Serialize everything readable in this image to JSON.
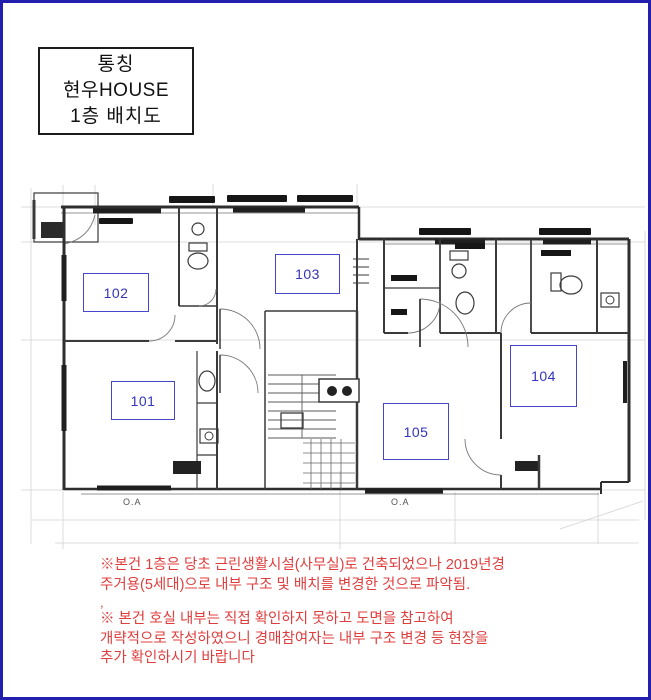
{
  "page": {
    "bg": "#ffffff",
    "border_color": "#221fae"
  },
  "title_box": {
    "line1": "통칭",
    "line2": "현우HOUSE",
    "line3": "1층  배치도"
  },
  "floorplan": {
    "label_color": "#3333bb",
    "room_labels": [
      {
        "number": "102"
      },
      {
        "number": "103"
      },
      {
        "number": "101"
      },
      {
        "number": "105"
      },
      {
        "number": "104"
      }
    ],
    "annotations": {
      "oa_left": "O.A",
      "oa_center": "O.A"
    }
  },
  "notes": {
    "color": "#e03e3e",
    "line1": "※본건 1층은 당초 근린생활시설(사무실)로 건축되었으나 2019년경",
    "line2": "주거용(5세대)으로 내부 구조 및 배치를 변경한 것으로 파악됨.",
    "separator": ",",
    "line3": "※ 본건 호실 내부는 직접 확인하지 못하고 도면을 참고하여",
    "line4": "개략적으로 작성하였으니 경매참여자는 내부 구조 변경 등 현장을",
    "line5": "추가 확인하시기 바랍니다"
  }
}
